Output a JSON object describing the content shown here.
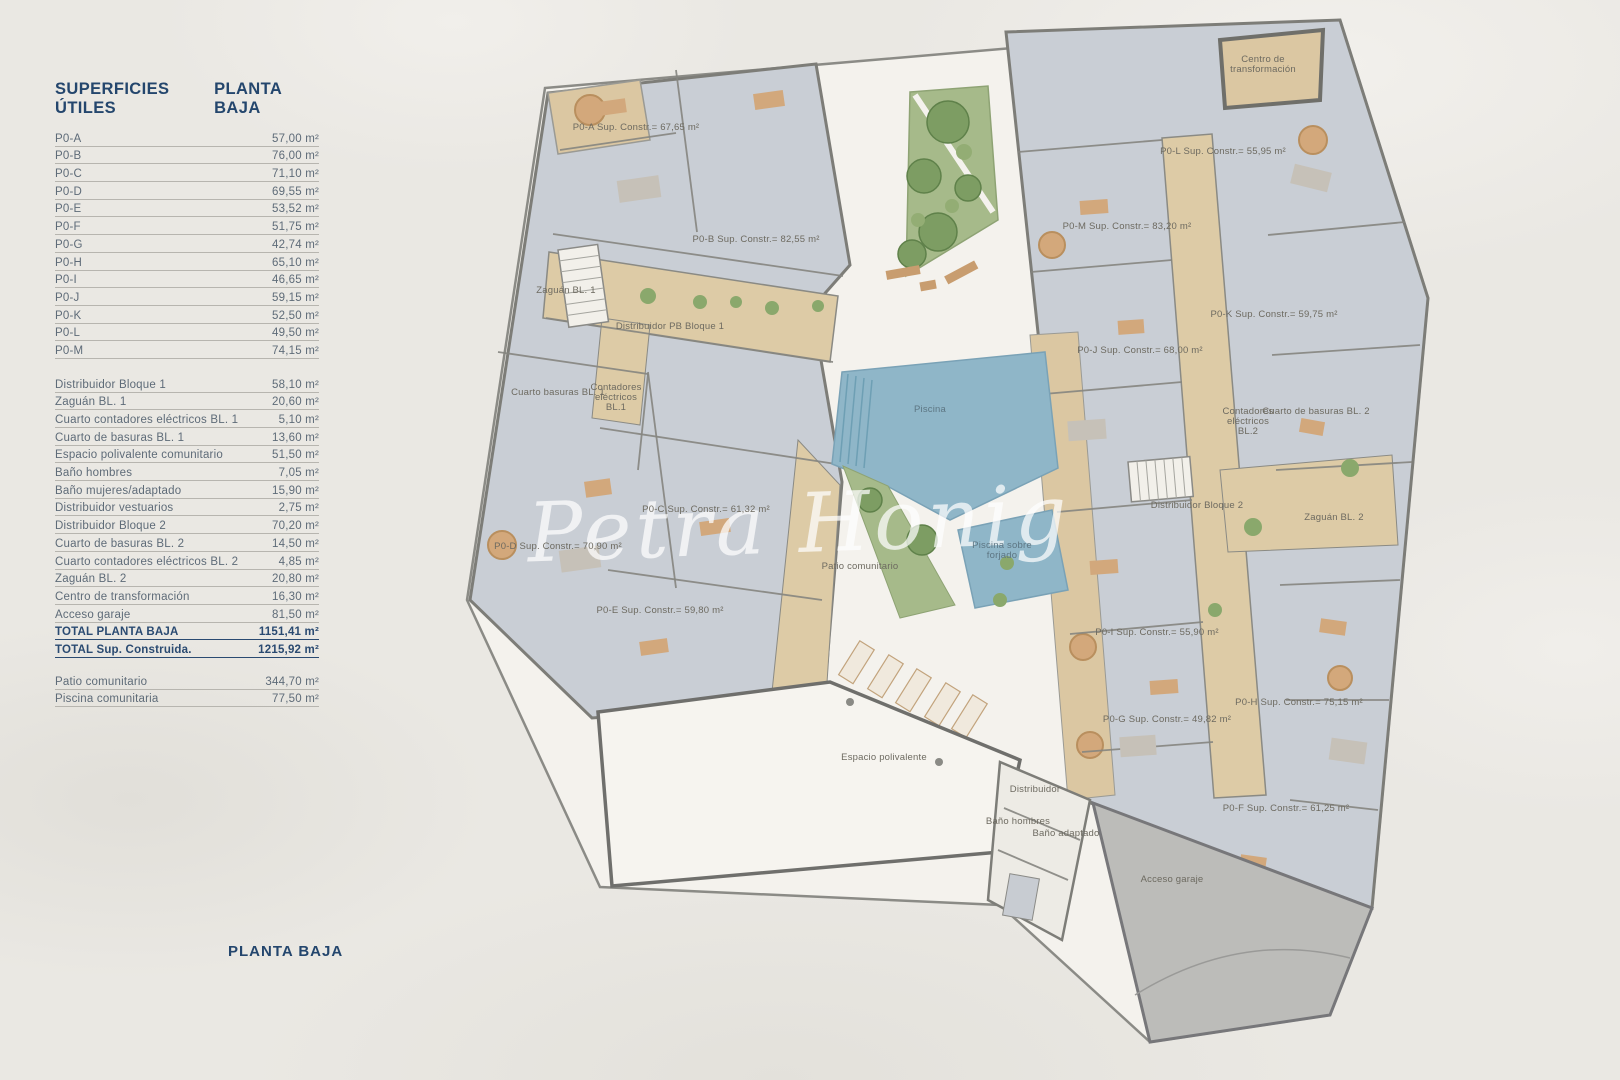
{
  "table": {
    "header": {
      "left": "SUPERFICIES ÚTILES",
      "right": "PLANTA BAJA"
    },
    "unit_rows": [
      {
        "label": "P0-A",
        "value": "57,00 m²"
      },
      {
        "label": "P0-B",
        "value": "76,00 m²"
      },
      {
        "label": "P0-C",
        "value": "71,10 m²"
      },
      {
        "label": "P0-D",
        "value": "69,55 m²"
      },
      {
        "label": "P0-E",
        "value": "53,52 m²"
      },
      {
        "label": "P0-F",
        "value": "51,75 m²"
      },
      {
        "label": "P0-G",
        "value": "42,74 m²"
      },
      {
        "label": "P0-H",
        "value": "65,10 m²"
      },
      {
        "label": "P0-I",
        "value": "46,65 m²"
      },
      {
        "label": "P0-J",
        "value": "59,15 m²"
      },
      {
        "label": "P0-K",
        "value": "52,50 m²"
      },
      {
        "label": "P0-L",
        "value": "49,50 m²"
      },
      {
        "label": "P0-M",
        "value": "74,15 m²"
      }
    ],
    "common_rows": [
      {
        "label": "Distribuidor Bloque 1",
        "value": "58,10 m²"
      },
      {
        "label": "Zaguán BL. 1",
        "value": "20,60 m²"
      },
      {
        "label": "Cuarto contadores eléctricos BL. 1",
        "value": "5,10 m²"
      },
      {
        "label": "Cuarto de basuras BL. 1",
        "value": "13,60 m²"
      },
      {
        "label": "Espacio polivalente comunitario",
        "value": "51,50 m²"
      },
      {
        "label": "Baño hombres",
        "value": "7,05 m²"
      },
      {
        "label": "Baño mujeres/adaptado",
        "value": "15,90 m²"
      },
      {
        "label": "Distribuidor vestuarios",
        "value": "2,75 m²"
      },
      {
        "label": "Distribuidor Bloque 2",
        "value": "70,20 m²"
      },
      {
        "label": "Cuarto de basuras BL. 2",
        "value": "14,50 m²"
      },
      {
        "label": "Cuarto contadores eléctricos BL. 2",
        "value": "4,85 m²"
      },
      {
        "label": "Zaguán BL. 2",
        "value": "20,80 m²"
      },
      {
        "label": "Centro de transformación",
        "value": "16,30 m²"
      },
      {
        "label": "Acceso garaje",
        "value": "81,50 m²"
      }
    ],
    "total_rows": [
      {
        "label": "TOTAL PLANTA BAJA",
        "value": "1151,41 m²"
      },
      {
        "label": "TOTAL Sup. Construida.",
        "value": "1215,92 m²"
      }
    ],
    "extra_rows": [
      {
        "label": "Patio comunitario",
        "value": "344,70 m²"
      },
      {
        "label": "Piscina comunitaria",
        "value": "77,50 m²"
      }
    ]
  },
  "footer_title": "PLANTA BAJA",
  "watermark": "Petra Honig",
  "colors": {
    "accent_navy": "#24466d",
    "row_text": "#5e6b78",
    "pool_blue": "#8fb6c8",
    "garden_green": "#a6ba8a",
    "corridor_tan": "#ddcba6",
    "room_gray_blue": "#c9ced5",
    "wall_gray": "#7d7d78",
    "ramp_gray": "#bcbcb9",
    "paper": "#eae8e3"
  },
  "plan": {
    "labels": [
      {
        "text": "P0-A Sup. Constr.= 67,65 m²",
        "x": 636,
        "y": 130
      },
      {
        "text": "P0-B Sup. Constr.= 82,55 m²",
        "x": 756,
        "y": 242
      },
      {
        "text": "Zaguán BL. 1",
        "x": 566,
        "y": 293
      },
      {
        "text": "Distribuidor PB Bloque 1",
        "x": 670,
        "y": 329
      },
      {
        "text": "Cuarto basuras BL. 1",
        "x": 558,
        "y": 395
      },
      {
        "text": "Contadores\neléctricos\nBL.1",
        "x": 616,
        "y": 390
      },
      {
        "text": "P0-C Sup. Constr.= 61,32 m²",
        "x": 706,
        "y": 512
      },
      {
        "text": "P0-D Sup. Constr.= 70,90 m²",
        "x": 558,
        "y": 549
      },
      {
        "text": "P0-E Sup. Constr.= 59,80 m²",
        "x": 660,
        "y": 613
      },
      {
        "text": "Centro de\ntransformación",
        "x": 1263,
        "y": 62
      },
      {
        "text": "P0-L Sup. Constr.= 55,95 m²",
        "x": 1223,
        "y": 154
      },
      {
        "text": "P0-M Sup. Constr.= 83,20 m²",
        "x": 1127,
        "y": 229
      },
      {
        "text": "P0-K Sup. Constr.= 59,75 m²",
        "x": 1274,
        "y": 317
      },
      {
        "text": "P0-J Sup. Constr.= 68,00 m²",
        "x": 1140,
        "y": 353
      },
      {
        "text": "Cuarto de basuras BL. 2",
        "x": 1316,
        "y": 414
      },
      {
        "text": "Contadores\neléctricos\nBL.2",
        "x": 1248,
        "y": 414
      },
      {
        "text": "Distribuidor Bloque 2",
        "x": 1197,
        "y": 508
      },
      {
        "text": "Zaguán BL. 2",
        "x": 1334,
        "y": 520
      },
      {
        "text": "P0-I Sup. Constr.= 55,90 m²",
        "x": 1157,
        "y": 635
      },
      {
        "text": "P0-G Sup. Constr.= 49,82 m²",
        "x": 1167,
        "y": 722
      },
      {
        "text": "P0-H Sup. Constr.= 75,15 m²",
        "x": 1299,
        "y": 705
      },
      {
        "text": "P0-F Sup. Constr.= 61,25 m²",
        "x": 1286,
        "y": 811
      },
      {
        "text": "Piscina",
        "x": 930,
        "y": 412,
        "cls": "blue"
      },
      {
        "text": "Piscina sobre\nforjado",
        "x": 1002,
        "y": 548,
        "cls": "blue"
      },
      {
        "text": "Patio comunitario",
        "x": 860,
        "y": 569
      },
      {
        "text": "Espacio polivalente",
        "x": 884,
        "y": 760
      },
      {
        "text": "Distribuidor",
        "x": 1035,
        "y": 792
      },
      {
        "text": "Baño hombres",
        "x": 1018,
        "y": 824
      },
      {
        "text": "Baño adaptado",
        "x": 1066,
        "y": 836
      },
      {
        "text": "Acceso garaje",
        "x": 1172,
        "y": 882
      }
    ]
  }
}
